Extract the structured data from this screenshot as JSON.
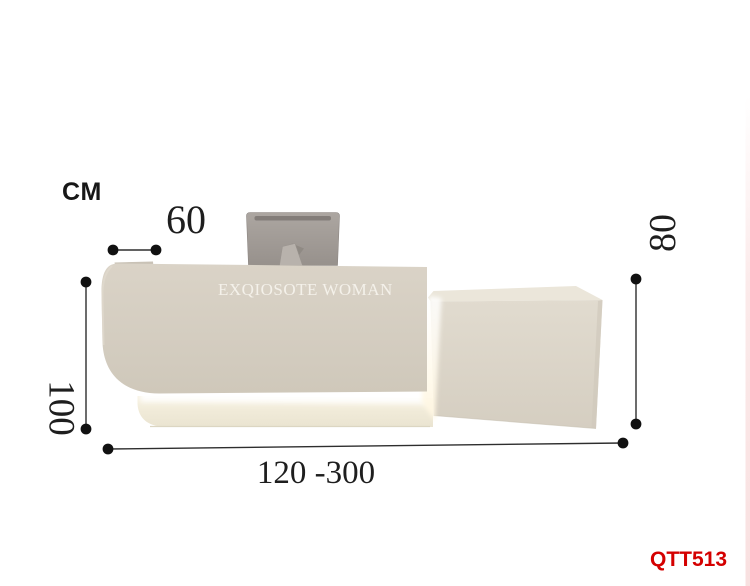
{
  "page": {
    "unit_label": "CM",
    "sku": "QTT513"
  },
  "desk": {
    "brand_text": "EXQIOSOTE WOMAN"
  },
  "dimensions": {
    "depth": "60",
    "left_height": "100",
    "right_height": "80",
    "width_range": "120 -300"
  },
  "colors": {
    "background": "#ffffff",
    "desk_panel_light": "#dad3c7",
    "desk_panel_dark": "#cfc8ba",
    "side_counter_front": "#ddd7ca",
    "side_counter_top": "#ebe6da",
    "base_plinth": "#f4eedd",
    "led_glow": "#ffffff",
    "monitor_gray": "#a09a95",
    "monitor_stand": "#b8b2ac",
    "dimension_line": "#2e2e2e",
    "dimension_dot": "#111111",
    "sku_red": "#d40000",
    "brand_text_color": "#f4f1ea"
  }
}
